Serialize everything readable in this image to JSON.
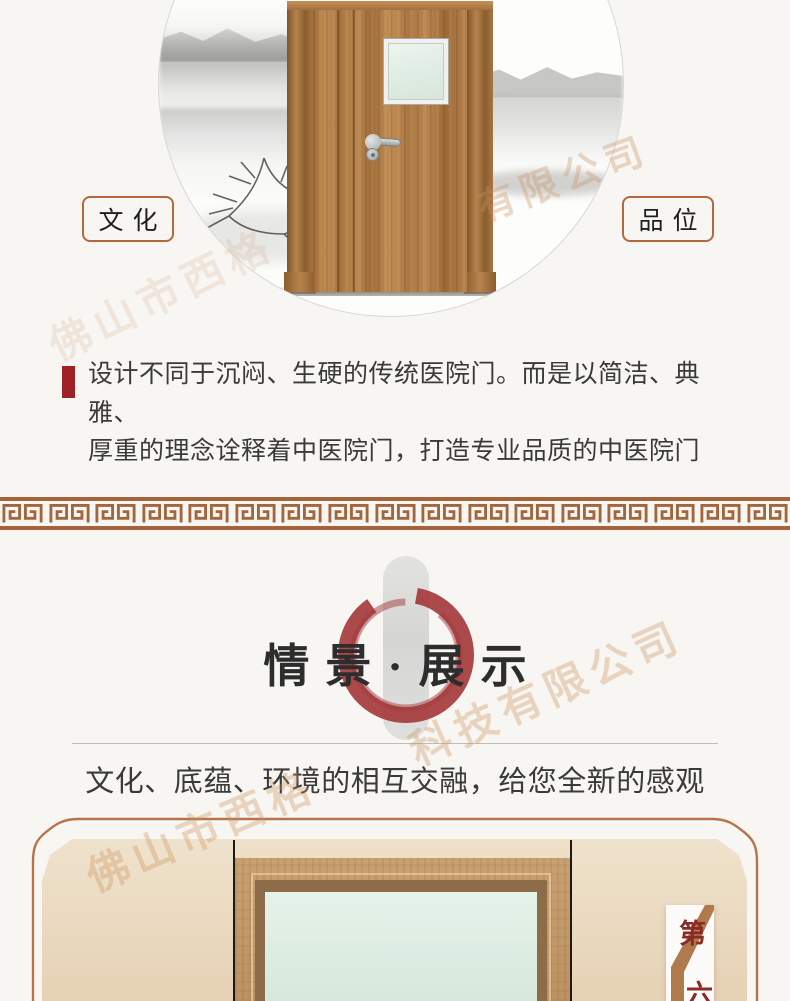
{
  "hero": {
    "label_left": "文化",
    "label_right": "品位",
    "description": {
      "line1": "设计不同于沉闷、生硬的传统医院门。而是以简洁、典雅、",
      "line2": "厚重的理念诠释着中医院门，打造专业品质的中医院门"
    }
  },
  "showcase": {
    "title": "情景·展示",
    "subtitle": "文化、底蕴、环境的相互交融，给您全新的感观",
    "badge": {
      "top": "第",
      "bottom": "六"
    }
  },
  "watermark": {
    "fragments": [
      "有限公司",
      "佛山市西格",
      "科技有限公司",
      "佛山市西格"
    ]
  },
  "colors": {
    "accent_red": "#9e2126",
    "brush_red": "#a43a3d",
    "border_brown": "#b5683c",
    "meander_brown": "#a5653a",
    "badge_red": "#8c2a26",
    "paper": "#f7f6f2",
    "panel_beige": "#ead9c0",
    "glass_green": "#dcebe1"
  }
}
